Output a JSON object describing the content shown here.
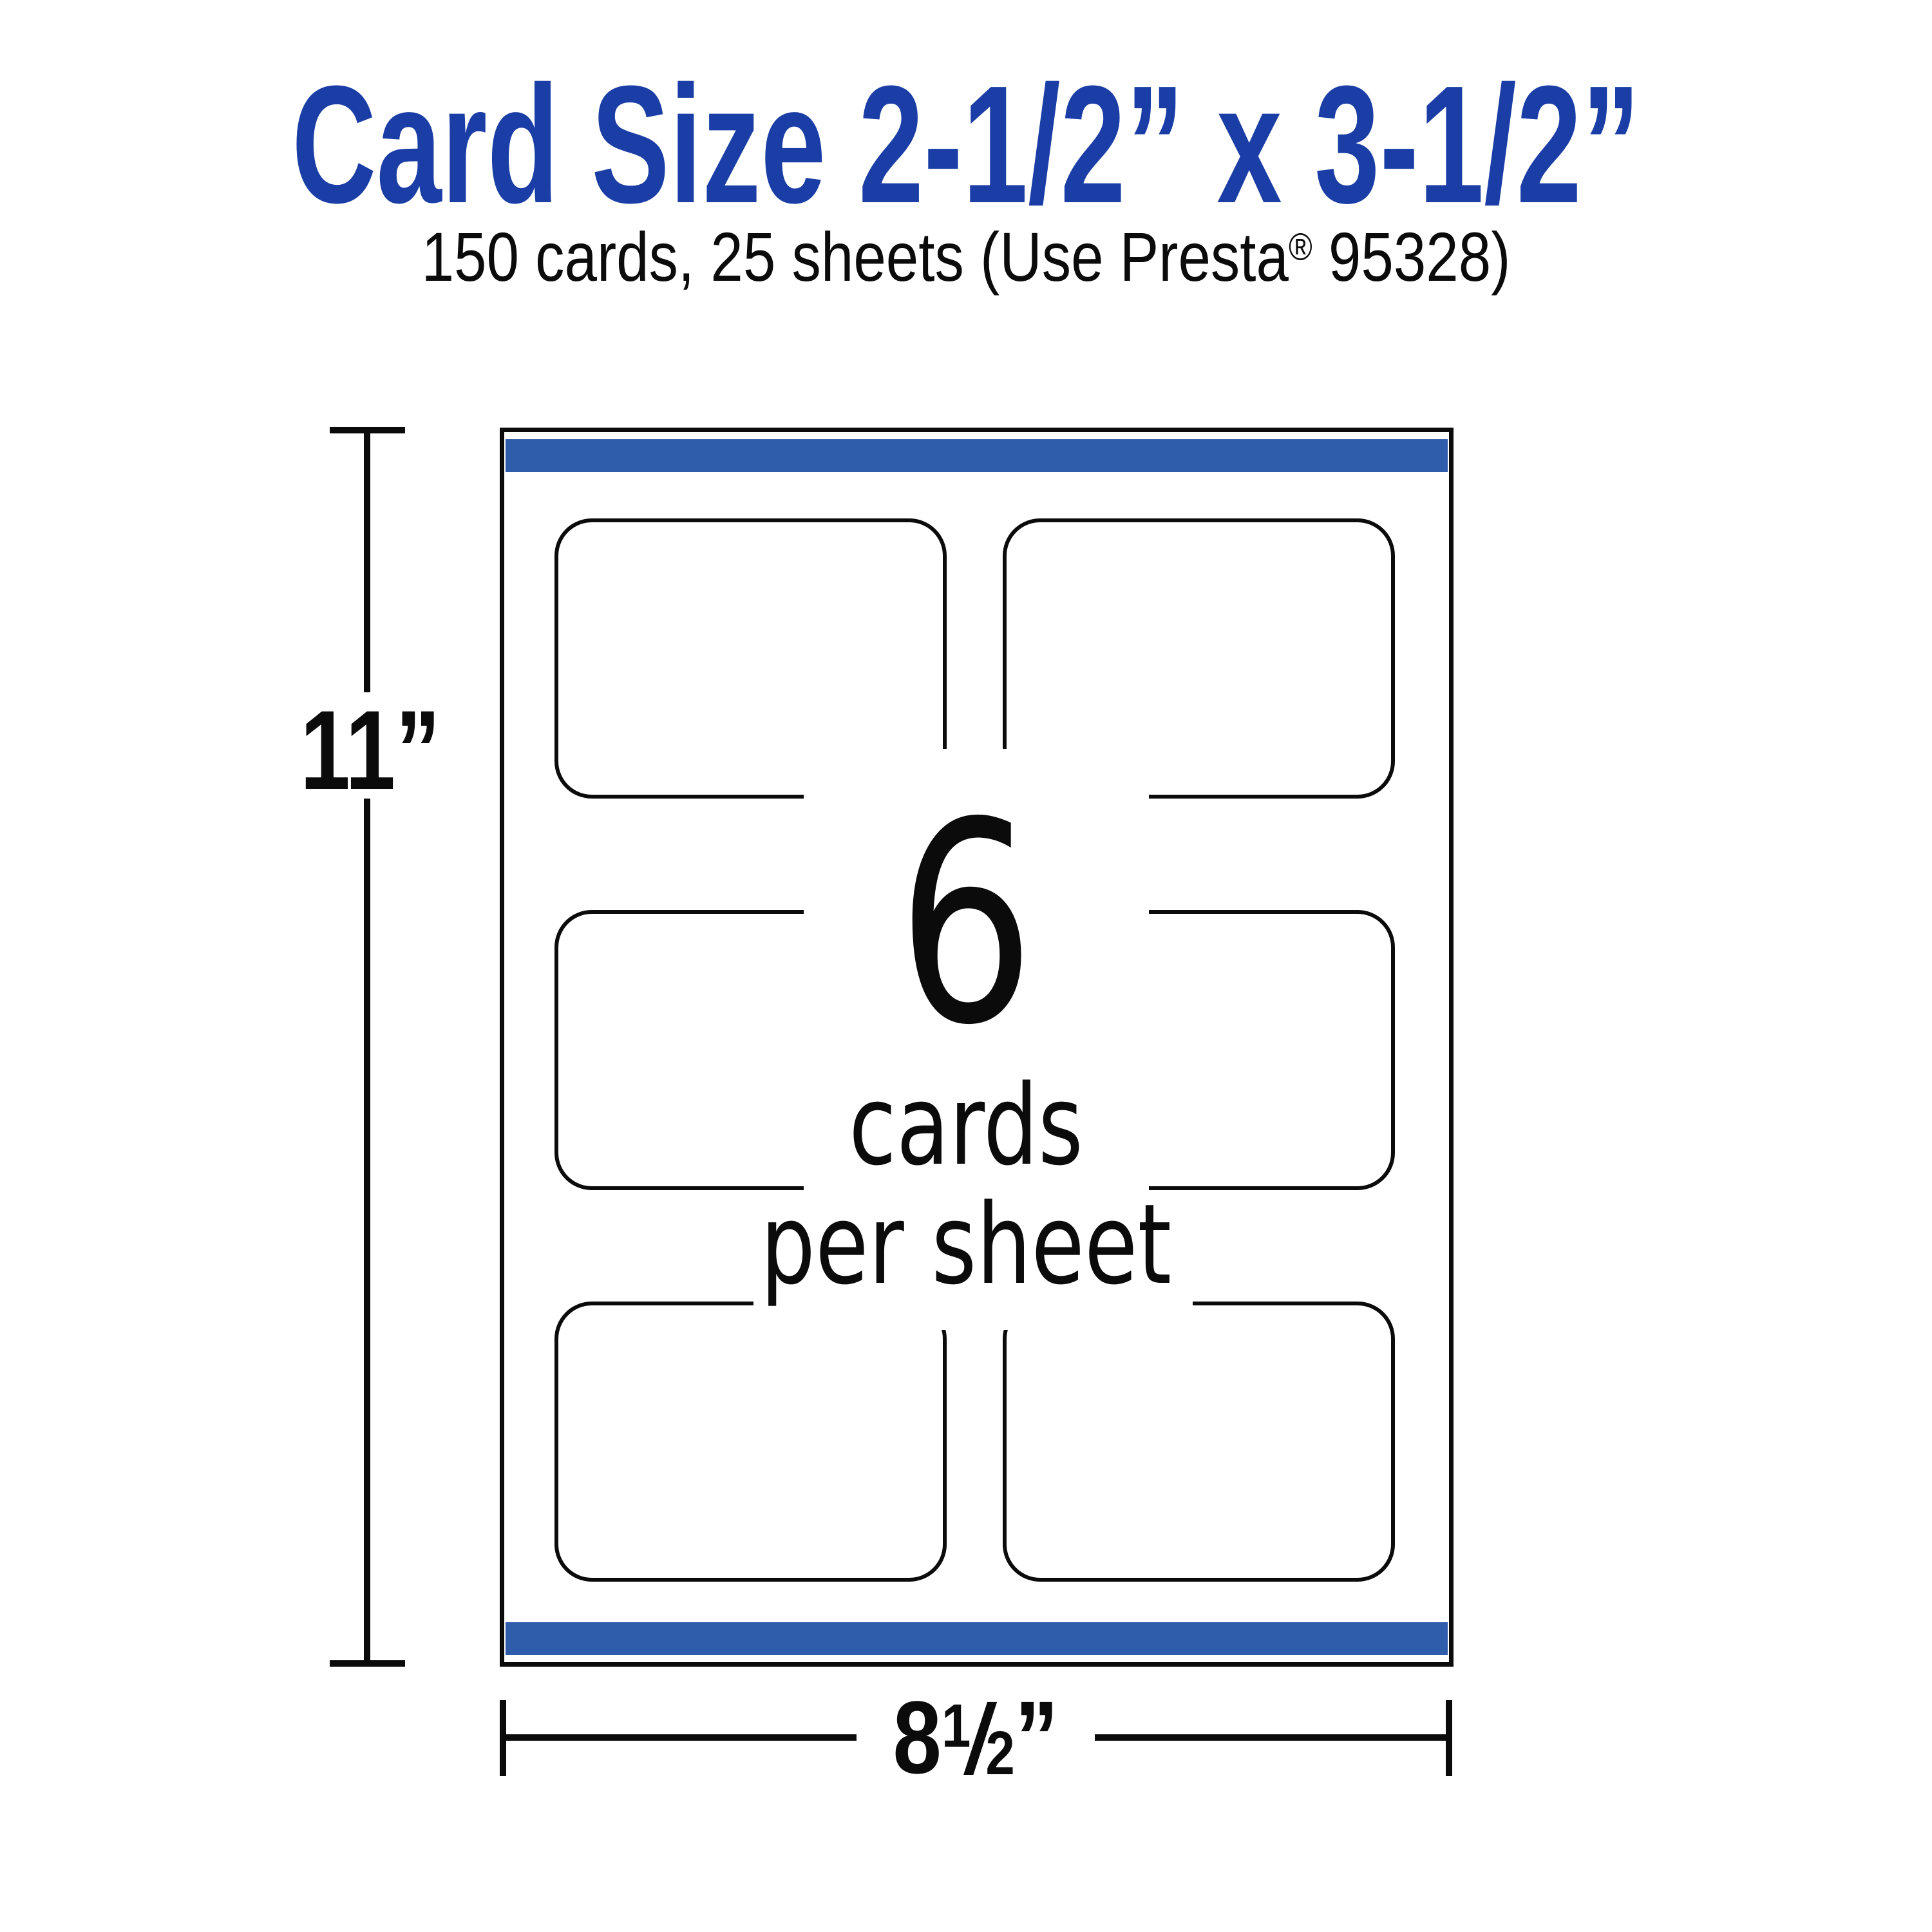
{
  "header": {
    "title": "Card Size 2-1/2” x 3-1/2”",
    "subtitle_pre": "150 cards, 25 sheets (Use Presta",
    "subtitle_reg": "®",
    "subtitle_post": " 95328)"
  },
  "diagram": {
    "center_count": "6",
    "center_line1": "cards",
    "center_line2": "per sheet",
    "height_label": "11”",
    "width_whole": "8",
    "width_frac_num": "1",
    "width_frac_slash": "/",
    "width_frac_den": "2",
    "width_unit": "”",
    "rows": 3,
    "columns": 2
  },
  "colors": {
    "title_blue": "#1b3ea6",
    "strip_blue": "#2f5cab",
    "ink": "#0b0b0b"
  }
}
